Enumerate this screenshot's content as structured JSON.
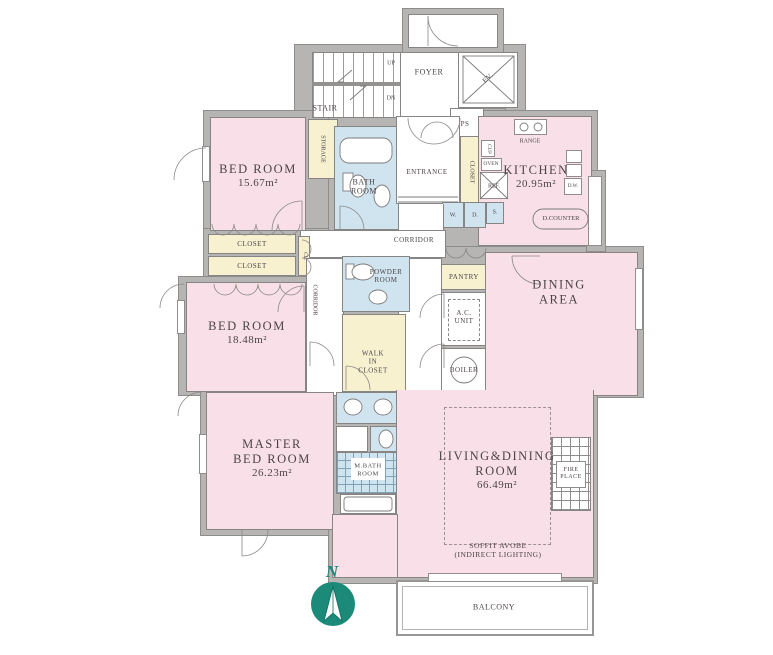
{
  "colors": {
    "room_pink": "#f9e0e8",
    "wet_blue": "#cfe4ef",
    "closet_yellow": "#f7f1d0",
    "wall_gray": "#b7b4b4",
    "compass_teal": "#1b8a79",
    "text": "#4c4449"
  },
  "rooms": {
    "bedroom1": {
      "name": "BED ROOM",
      "area": "15.67m²"
    },
    "bedroom2": {
      "name": "BED ROOM",
      "area": "18.48m²"
    },
    "master": {
      "l1": "MASTER",
      "l2": "BED ROOM",
      "area": "26.23m²"
    },
    "kitchen": {
      "name": "KITCHEN",
      "area": "20.95m²"
    },
    "dining": {
      "l1": "DINING",
      "l2": "AREA"
    },
    "living": {
      "l1": "LIVING&DINING",
      "l2": "ROOM",
      "area": "66.49m²"
    },
    "bath": {
      "l1": "BATH",
      "l2": "ROOM"
    },
    "powder": {
      "l1": "POWDER",
      "l2": "ROOM"
    },
    "mbath": {
      "l1": "M.BATH",
      "l2": "ROOM"
    },
    "walkin": {
      "l1": "WALK",
      "l2": "IN",
      "l3": "CLOSET"
    },
    "balcony": "BALCONY"
  },
  "labels": {
    "stair": "STAIR",
    "up": "UP",
    "dn": "DN",
    "foyer": "FOYER",
    "ev": "EV.",
    "ps": "PS",
    "entrance": "ENTRANCE",
    "closet_entry": "CLOSET",
    "storage": "STORAGE",
    "corridor_h": "CORRIDOR",
    "corridor_v": "CORRIDOR",
    "closet1": "CLOSET",
    "closet2": "CLOSET",
    "cl": "CL.",
    "pantry": "PANTRY",
    "ac1": "A.C.",
    "ac2": "UNIT",
    "boiler": "BOILER",
    "range": "RANGE",
    "cup": "CUP",
    "oven": "OVEN",
    "ref": "REF.",
    "dw": "D.W.",
    "dcounter": "D.COUNTER",
    "w": "W.",
    "d": "D.",
    "s": "S.",
    "fire1": "FIRE",
    "fire2": "PLACE",
    "soffit1": "SOFFIT AVOBE",
    "soffit2": "(INDIRECT LIGHTING)",
    "north": "N"
  }
}
